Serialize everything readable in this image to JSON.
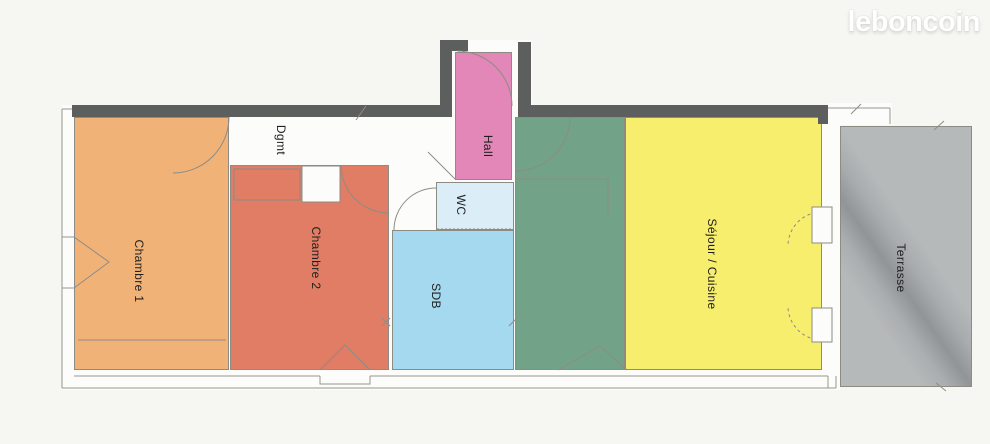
{
  "watermark": {
    "text": "leboncoin"
  },
  "plan": {
    "title": "Floor plan of apartment with terrace",
    "colors": {
      "wall": "#5d5e5e",
      "thin_line": "#97968e",
      "page_background": "#f6f6f3",
      "interior_background": "#fcfcfa",
      "label": "#1f1f1f"
    },
    "rooms": [
      {
        "id": "chambre-1",
        "label": "Chambre 1",
        "color": "#f1b278",
        "border": true,
        "x": 74,
        "y": 117,
        "w": 155,
        "h": 253,
        "lx": 139,
        "ly": 271
      },
      {
        "id": "degagement",
        "label": "Dgmt",
        "color": "transparent",
        "border": false,
        "x": 230,
        "y": 117,
        "w": 225,
        "h": 48,
        "lx": 281,
        "ly": 140
      },
      {
        "id": "chambre-2",
        "label": "Chambre 2",
        "color": "#e07d64",
        "border": true,
        "x": 230,
        "y": 165,
        "w": 159,
        "h": 205,
        "lx": 316,
        "ly": 258
      },
      {
        "id": "hall",
        "label": "Hall",
        "color": "#e287b7",
        "border": true,
        "x": 455,
        "y": 52,
        "w": 57,
        "h": 128,
        "lx": 488,
        "ly": 146
      },
      {
        "id": "wc",
        "label": "WC",
        "color": "#dbeef7",
        "border": true,
        "x": 436,
        "y": 182,
        "w": 78,
        "h": 48,
        "lx": 461,
        "ly": 205
      },
      {
        "id": "sdb",
        "label": "SDB",
        "color": "#a4d9ef",
        "border": true,
        "x": 392,
        "y": 230,
        "w": 122,
        "h": 140,
        "lx": 436,
        "ly": 296
      },
      {
        "id": "cuisine-zone",
        "label": "",
        "color": "#72a287",
        "border": true,
        "x": 515,
        "y": 117,
        "w": 110,
        "h": 253,
        "lx": 0,
        "ly": 0
      },
      {
        "id": "sejour-cuisine",
        "label": "Séjour / Cuisine",
        "color": "#f8ee6e",
        "border": true,
        "x": 625,
        "y": 117,
        "w": 197,
        "h": 253,
        "lx": 712,
        "ly": 264
      },
      {
        "id": "terrasse",
        "label": "Terrasse",
        "color": "#b6b9ba",
        "border": true,
        "x": 840,
        "y": 126,
        "w": 132,
        "h": 261,
        "lx": 901,
        "ly": 268,
        "smudge": true
      }
    ]
  }
}
